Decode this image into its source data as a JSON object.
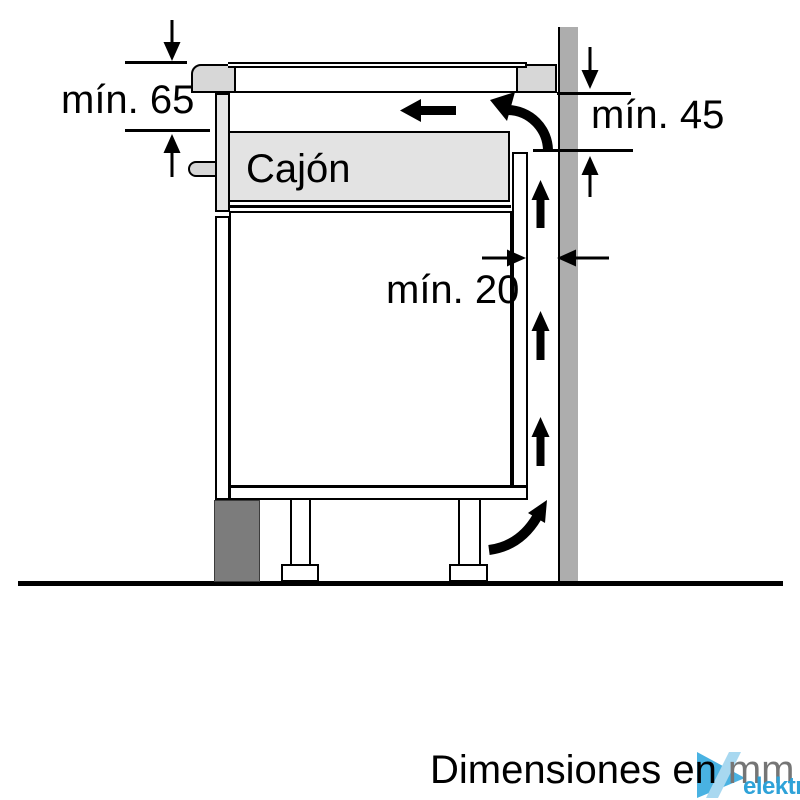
{
  "diagram": {
    "type": "hob-installation-clearance-diagram",
    "labels": {
      "drawer": "Cajón",
      "clearance_top": "mín. 65",
      "clearance_right": "mín. 45",
      "clearance_rear": "mín. 20"
    },
    "footer": {
      "caption": "Dimensiones en",
      "unit": "mm"
    },
    "watermark": {
      "brand": "elektra"
    },
    "colors": {
      "outline": "#000000",
      "wall_gray": "#ADADAD",
      "plinth_gray": "#7C7C7C",
      "hob_trim_gray": "#D7D7D7",
      "drawer_gray": "#E3E3E3",
      "unit_text_gray": "#757575",
      "brand_blue": "#49B2E2",
      "brand_blue_light": "#A8D8F0",
      "brand_text_blue": "#2EA2D8"
    },
    "icons": {
      "airflow-up-arrow": "thick black triangle-head arrow, svg shape",
      "airflow-left-arrow": "thick black left arrow, svg shape",
      "airflow-curved-arrow": "curved black arrow, svg path",
      "dimension-arrow": "thin black triangular dimension arrow, svg shape",
      "brand-mark": "blue right triangle with light diagonal slash"
    }
  }
}
